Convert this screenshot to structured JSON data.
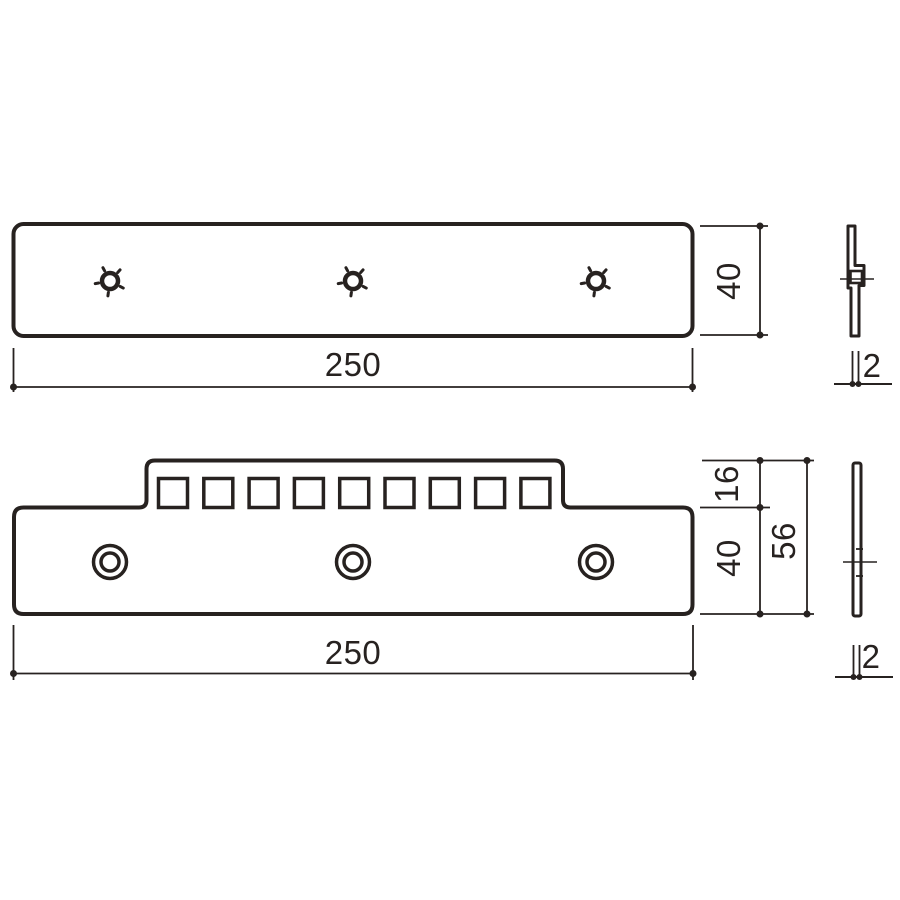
{
  "colors": {
    "line": "#272220",
    "background": "#ffffff"
  },
  "views": {
    "top_plate": {
      "width_dim": "250",
      "height_dim": "40",
      "hole_count": 3
    },
    "top_plate_side": {
      "thickness_dim": "2"
    },
    "bottom_plate": {
      "width_dim": "250",
      "tab_height_dim": "16",
      "body_height_dim": "40",
      "total_height_dim": "56",
      "square_hole_count": 9,
      "round_hole_count": 3
    },
    "bottom_plate_side": {
      "thickness_dim": "2"
    }
  }
}
